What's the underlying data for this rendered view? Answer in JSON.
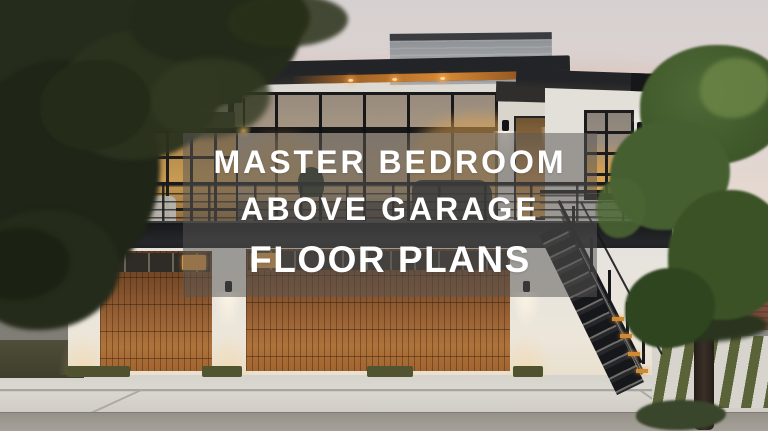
{
  "hero_title": {
    "line1": "MASTER BEDROOM",
    "line2": "ABOVE GARAGE",
    "line3": "FLOOR PLANS"
  },
  "overlay": {
    "background": "rgba(88,86,84,0.52)",
    "text_color": "#ffffff"
  },
  "scene_palette": {
    "sky_top": "#d6d0d0",
    "sky_horizon": "#ecdccc",
    "roof_dark": "#232427",
    "wall_white": "#e6e3de",
    "garage_wood": "#8a5730",
    "window_glow": "#d8a050",
    "foliage_dark": "#222819",
    "foliage_green": "#44602f",
    "driveway": "#d4d1ca"
  }
}
